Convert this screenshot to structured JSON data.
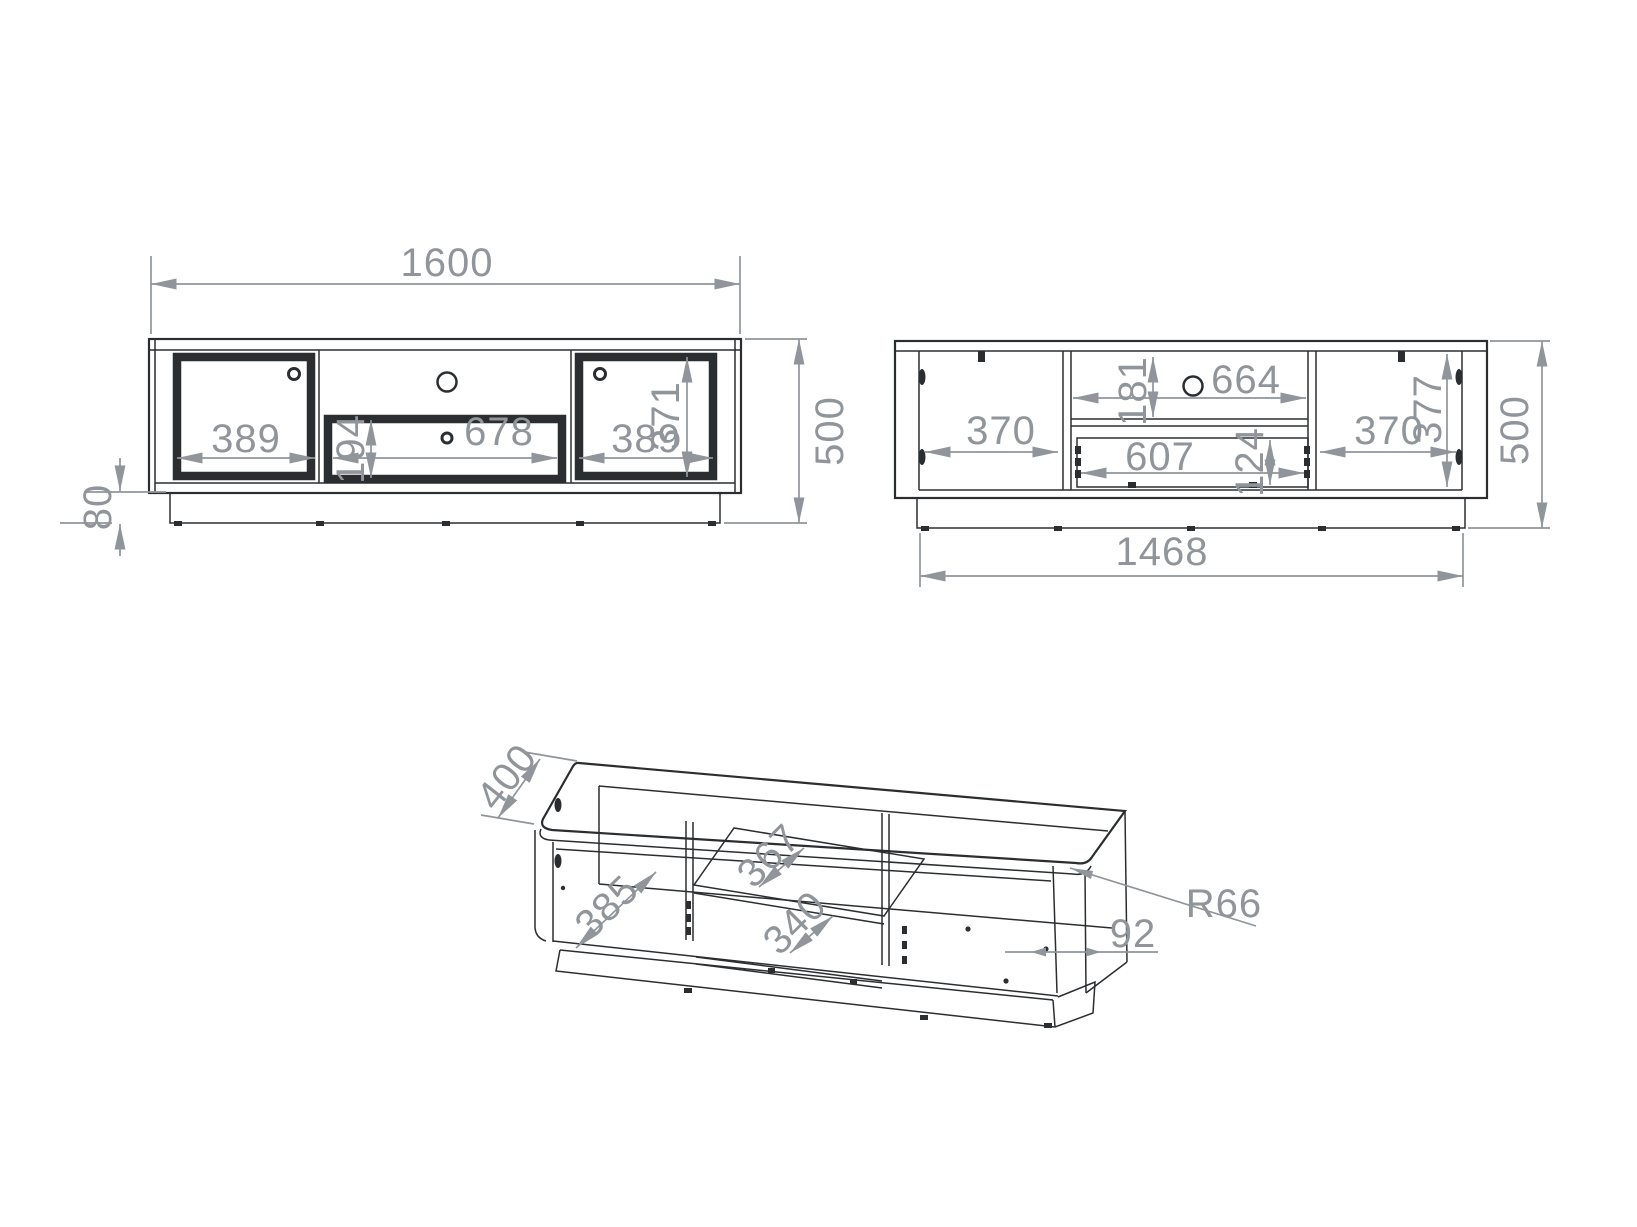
{
  "drawing": {
    "type": "furniture technical drawing (TV stand, three orthographic/isometric views)",
    "colors": {
      "background": "#ffffff",
      "line": "#2b2e30",
      "dimension": "#8f959a"
    },
    "views": {
      "front": {
        "overall_width": "1600",
        "overall_height": "500",
        "plinth_height": "80",
        "left_door_width": "389",
        "drawer_front_height": "194",
        "drawer_front_width": "678",
        "right_door_width": "389",
        "door_height": "371"
      },
      "carcass": {
        "left_compartment_width": "370",
        "top_niche_height": "181",
        "top_niche_width": "664",
        "drawer_inner_width": "607",
        "drawer_inner_height": "124",
        "right_compartment_width": "370",
        "inner_height": "377",
        "overall_height": "500",
        "inner_width": "1468"
      },
      "isometric": {
        "depth": "400",
        "compartment_depth": "385",
        "shelf_depth": "367",
        "drawer_depth": "340",
        "corner_radius": "R66",
        "side_panel_depth": "92"
      }
    }
  }
}
